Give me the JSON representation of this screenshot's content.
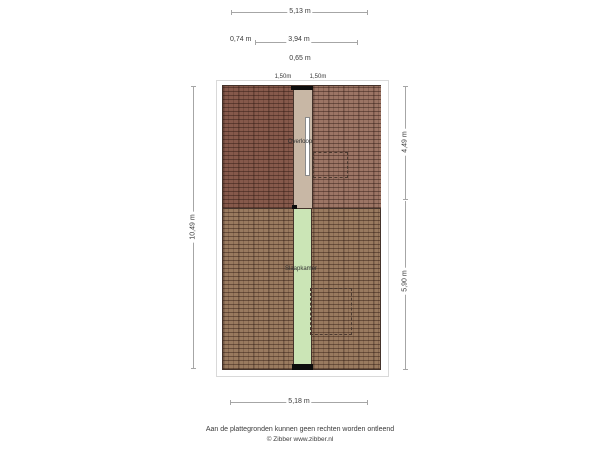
{
  "floorplan": {
    "title": "verdieping-plattegrond",
    "rooms": {
      "landing": "Overloop",
      "bedroom": "Slaapkamer"
    },
    "dimensions": {
      "width_total_top": "5,13 m",
      "segment_left_top": "0,74 m",
      "segment_mid_top": "3,94 m",
      "segment_small_top": "0,65 m",
      "opening_left": "1,50m",
      "opening_right": "1,50m",
      "height_total_left": "10,49 m",
      "height_upper_right": "4,49 m",
      "height_lower_right": "5,90 m",
      "width_total_bottom": "5,18 m"
    },
    "colors": {
      "roof_hatch_upper_left": "#86594b",
      "roof_hatch_upper_right": "#9c7565",
      "roof_hatch_lower": "#997a5f",
      "landing_floor": "#c8b7a5",
      "bedroom_floor": "#cbe5b6",
      "wall_outline": "#44332b"
    }
  },
  "footer": {
    "disclaimer": "Aan de plattegronden kunnen geen rechten worden ontleend",
    "credit": "© Zibber www.zibber.nl"
  }
}
